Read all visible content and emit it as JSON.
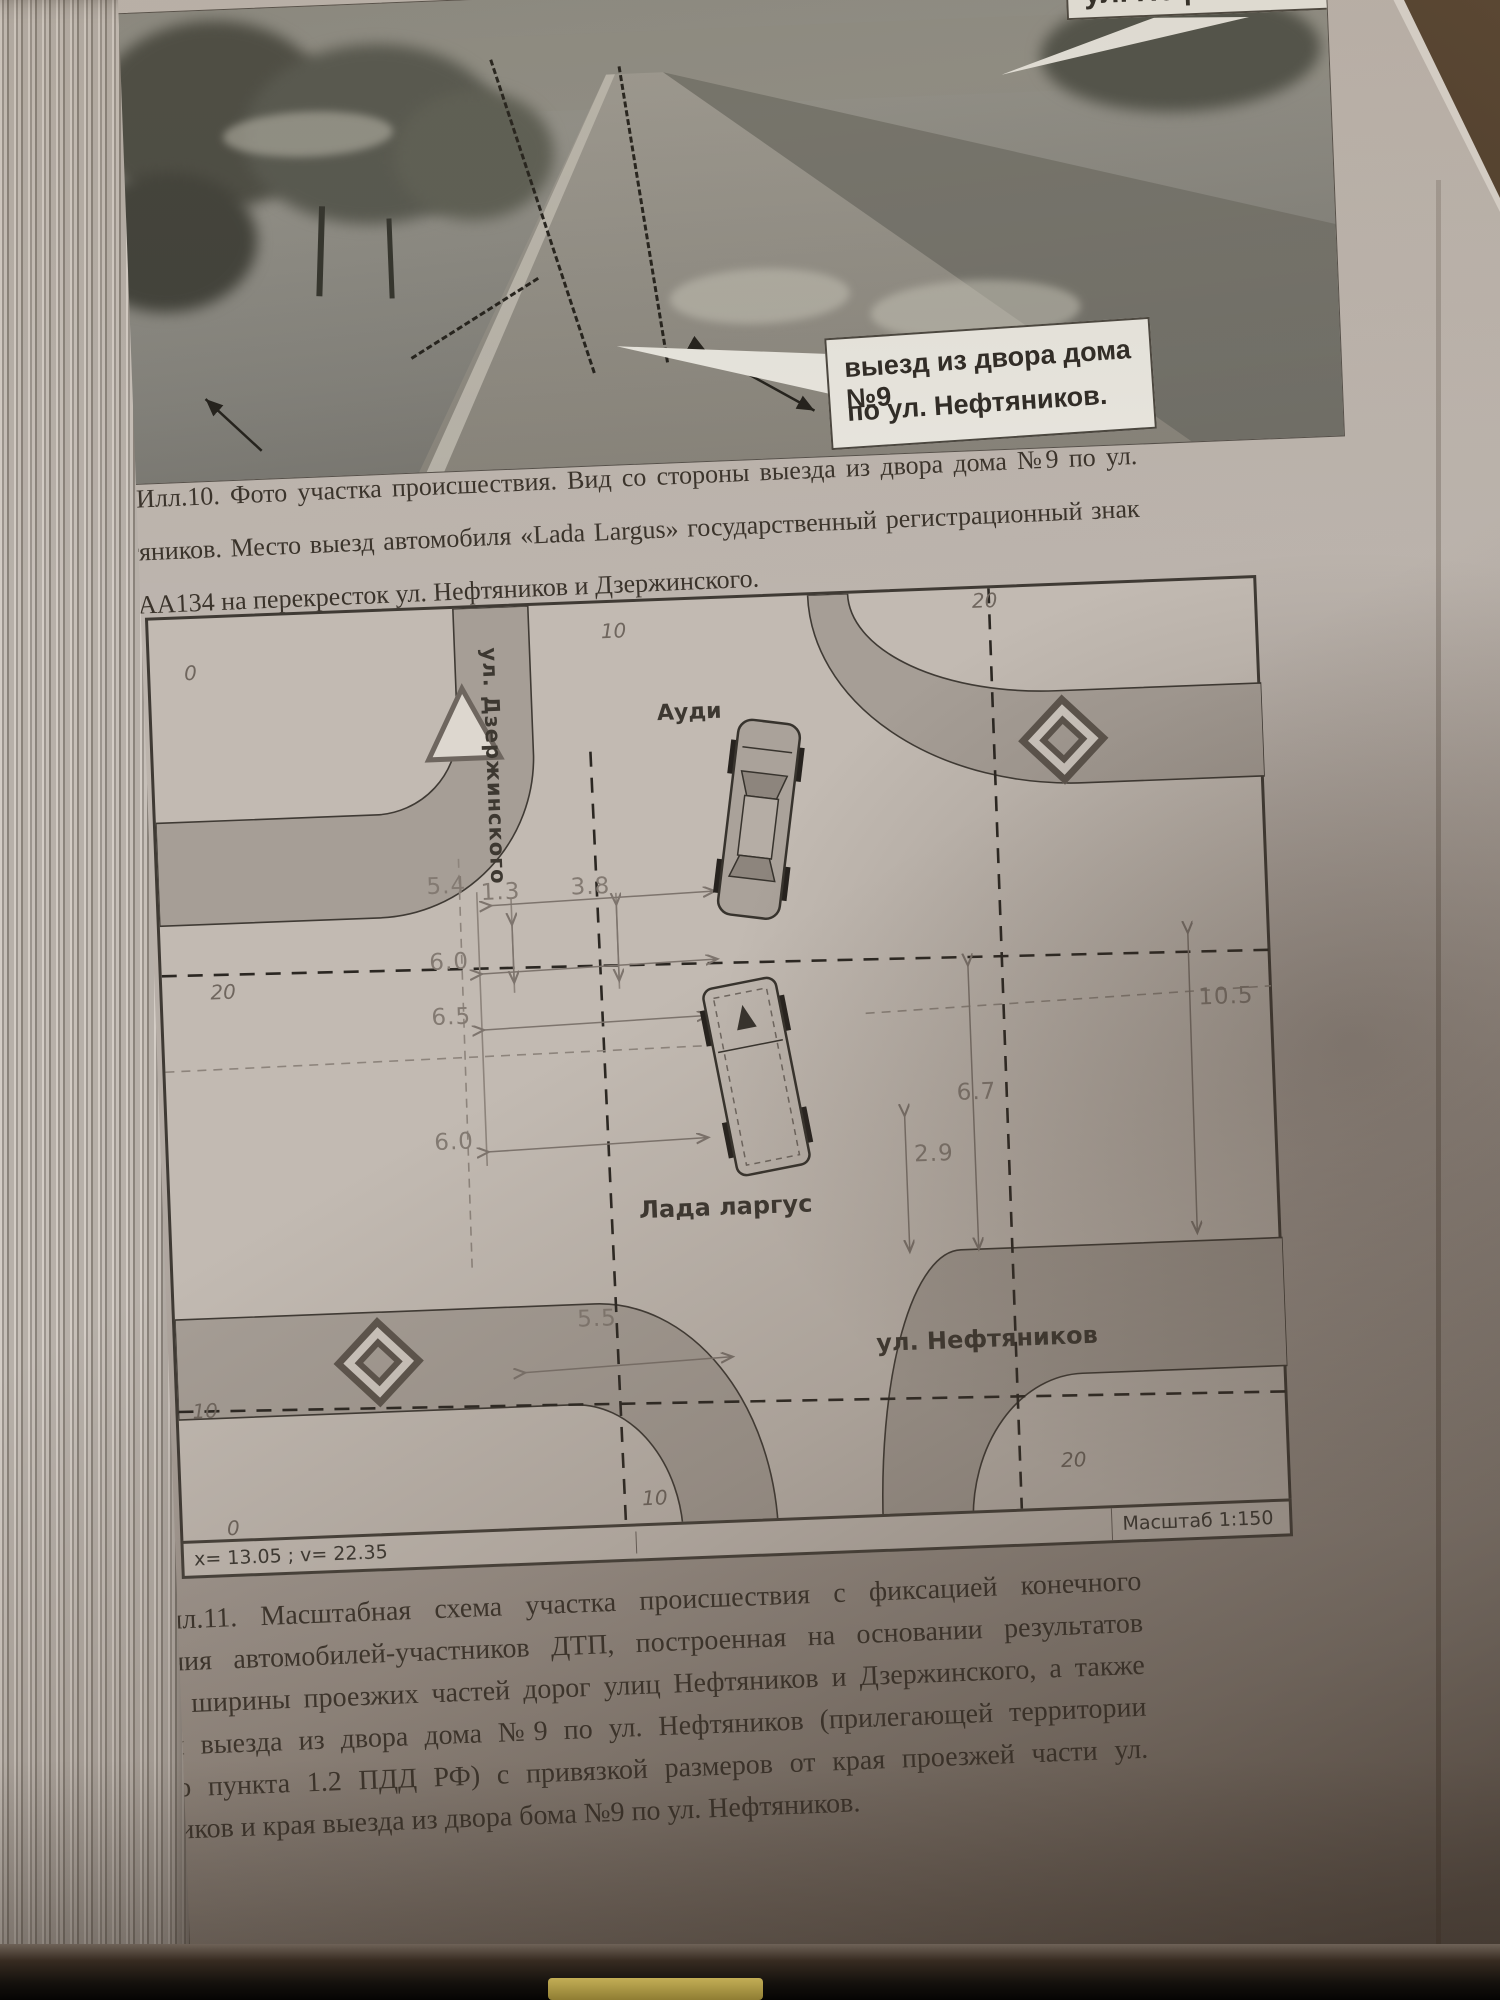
{
  "page": {
    "photo_annotations": {
      "street_callout": "ул. Нефтяников",
      "exit_callout_line1": "выезд из двора дома №9",
      "exit_callout_line2": "по ул. Нефтяников."
    },
    "caption_ill10": "Илл.10. Фото участка происшествия. Вид со стороны выезда из двора дома №9 по ул. Нефтяников. Место выезд автомобиля «Lada Largus» государственный регистрационный знак В110АА134 на перекресток ул. Нефтяников и Дзержинского.",
    "diagram": {
      "street_vertical": "ул. Дзержинского",
      "street_horizontal": "ул. Нефтяников",
      "car_top": "Ауди",
      "car_bottom": "Лада ларгус",
      "dim_54": "5.4",
      "dim_13": "1.3",
      "dim_38": "3.8",
      "dim_60a": "6.0",
      "dim_65": "6.5",
      "dim_60b": "6.0",
      "dim_55": "5.5",
      "dim_67": "6.7",
      "dim_29": "2.9",
      "dim_105": "10.5",
      "tick_top_0": "0",
      "tick_top_10": "10",
      "tick_top_20": "20",
      "tick_left_20": "20",
      "tick_left_10": "10",
      "tick_bottom_0": "0",
      "tick_bottom_10": "10",
      "tick_bottom_20": "20",
      "coords_readout": "х= 13.05 ; v= 22.35",
      "scale_label": "Масштаб 1:150"
    },
    "caption_ill11": "Илл.11. Масштабная схема участка происшествия с фиксацией конечного положения автомобилей-участников ДТП, построенная на основании результатов замеров ширины проезжих частей дорог улиц Нефтяников и Дзержинского, а также ширины выезда из двора дома №9 по ул. Нефтяников (прилегающей территории согласно пункта 1.2 ПДД РФ) с привязкой размеров от края проезжей части ул. Нефтяников и края выезда из двора бома №9 по ул. Нефтяников."
  }
}
